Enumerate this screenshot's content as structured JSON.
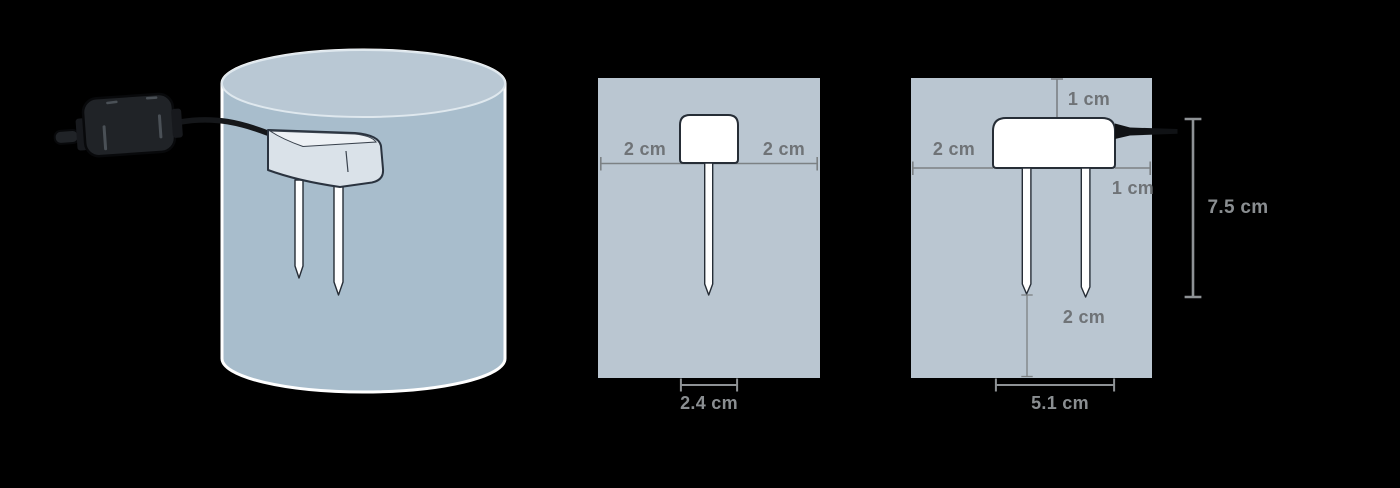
{
  "colors": {
    "background": "#000000",
    "panel": "#bac6d1",
    "pot_body": "#a8bdcc",
    "pot_top": "#b9c8d4",
    "sensor_white": "#ffffff",
    "outline_dark": "#262d36",
    "dimension_line_on_panel": "#7c8184",
    "dimension_line_on_black": "#8e9295",
    "label_gray": "#6f7377",
    "label_gray_on_black": "#8a8e91",
    "cable_black": "#15171a",
    "adapter_black": "#202327"
  },
  "front_view": {
    "labels": {
      "left_width": "2 cm",
      "right_width": "2 cm",
      "head_width": "2.4 cm"
    }
  },
  "side_view": {
    "labels": {
      "top_offset": "1 cm",
      "left_width": "2 cm",
      "right_offset": "1 cm",
      "total_height": "7.5 cm",
      "pin_tip_clearance": "2 cm",
      "head_width": "5.1 cm"
    }
  }
}
